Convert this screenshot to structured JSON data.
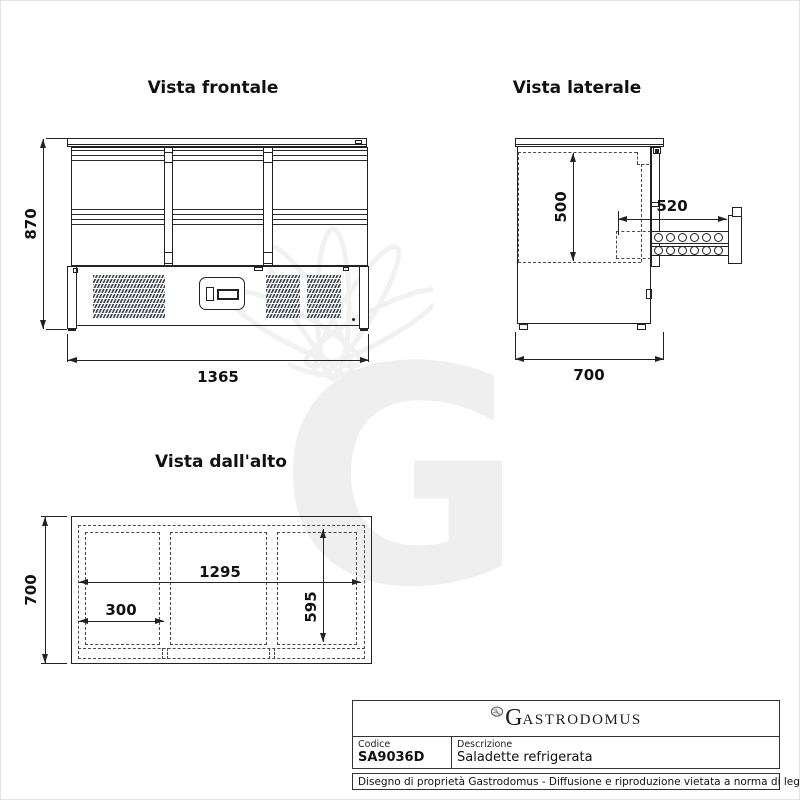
{
  "views": {
    "front": {
      "title": "Vista frontale",
      "height": "870",
      "width": "1365"
    },
    "side": {
      "title": "Vista laterale",
      "inner_height": "500",
      "drawer_extension": "520",
      "depth": "700"
    },
    "top": {
      "title": "Vista dall'alto",
      "depth": "700",
      "inner_width": "1295",
      "section_width": "300",
      "inner_depth": "595"
    }
  },
  "watermark": {
    "letter": "G"
  },
  "title_block": {
    "brand_initial": "G",
    "brand_rest": "ASTRODOMUS",
    "code_label": "Codice",
    "code_value": "SA9036D",
    "description_label": "Descrizione",
    "description_value": "Saladette refrigerata",
    "legal": "Disegno di proprietà Gastrodomus - Diffusione e riproduzione vietata a norma di legge."
  },
  "colors": {
    "line": "#222222",
    "dash": "#4a4a4a",
    "watermark": "#efefef",
    "grille": "#3a4049"
  }
}
